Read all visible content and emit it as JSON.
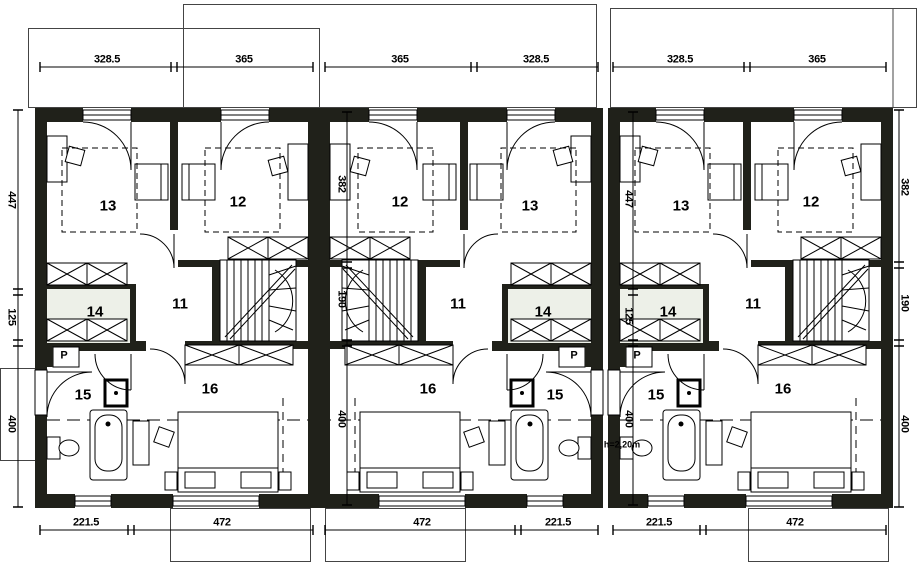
{
  "units": [
    {
      "id": "unit-1",
      "top_dims": [
        "328.5",
        "365"
      ],
      "bottom_dims": [
        "221.5",
        "472"
      ],
      "rooms": {
        "r11": "11",
        "r12": "12",
        "r13": "13",
        "r14": "14",
        "r15": "15",
        "r16": "16",
        "closet": "P"
      }
    },
    {
      "id": "unit-2",
      "top_dims": [
        "365",
        "328.5"
      ],
      "bottom_dims": [
        "472",
        "221.5"
      ],
      "rooms": {
        "r11": "11",
        "r12": "12",
        "r13": "13",
        "r14": "14",
        "r15": "15",
        "r16": "16",
        "closet": "P"
      }
    },
    {
      "id": "unit-3",
      "top_dims": [
        "328.5",
        "365"
      ],
      "bottom_dims": [
        "221.5",
        "472"
      ],
      "rooms": {
        "r11": "11",
        "r12": "12",
        "r13": "13",
        "r14": "14",
        "r15": "15",
        "r16": "16",
        "closet": "P"
      }
    }
  ],
  "side_dimensions": {
    "left": [
      "447",
      "125",
      "400"
    ],
    "right": [
      "382",
      "190",
      "400"
    ],
    "unit2_inner": [
      "382",
      "190",
      "400"
    ],
    "unit3_inner": [
      "447",
      "125",
      "400"
    ]
  },
  "annotations": {
    "height_note": "h=2,20m"
  },
  "colors": {
    "wall": "#20211a",
    "room14_tint": "#edf0e8",
    "line": "#000000",
    "roof_line": "#444444"
  }
}
